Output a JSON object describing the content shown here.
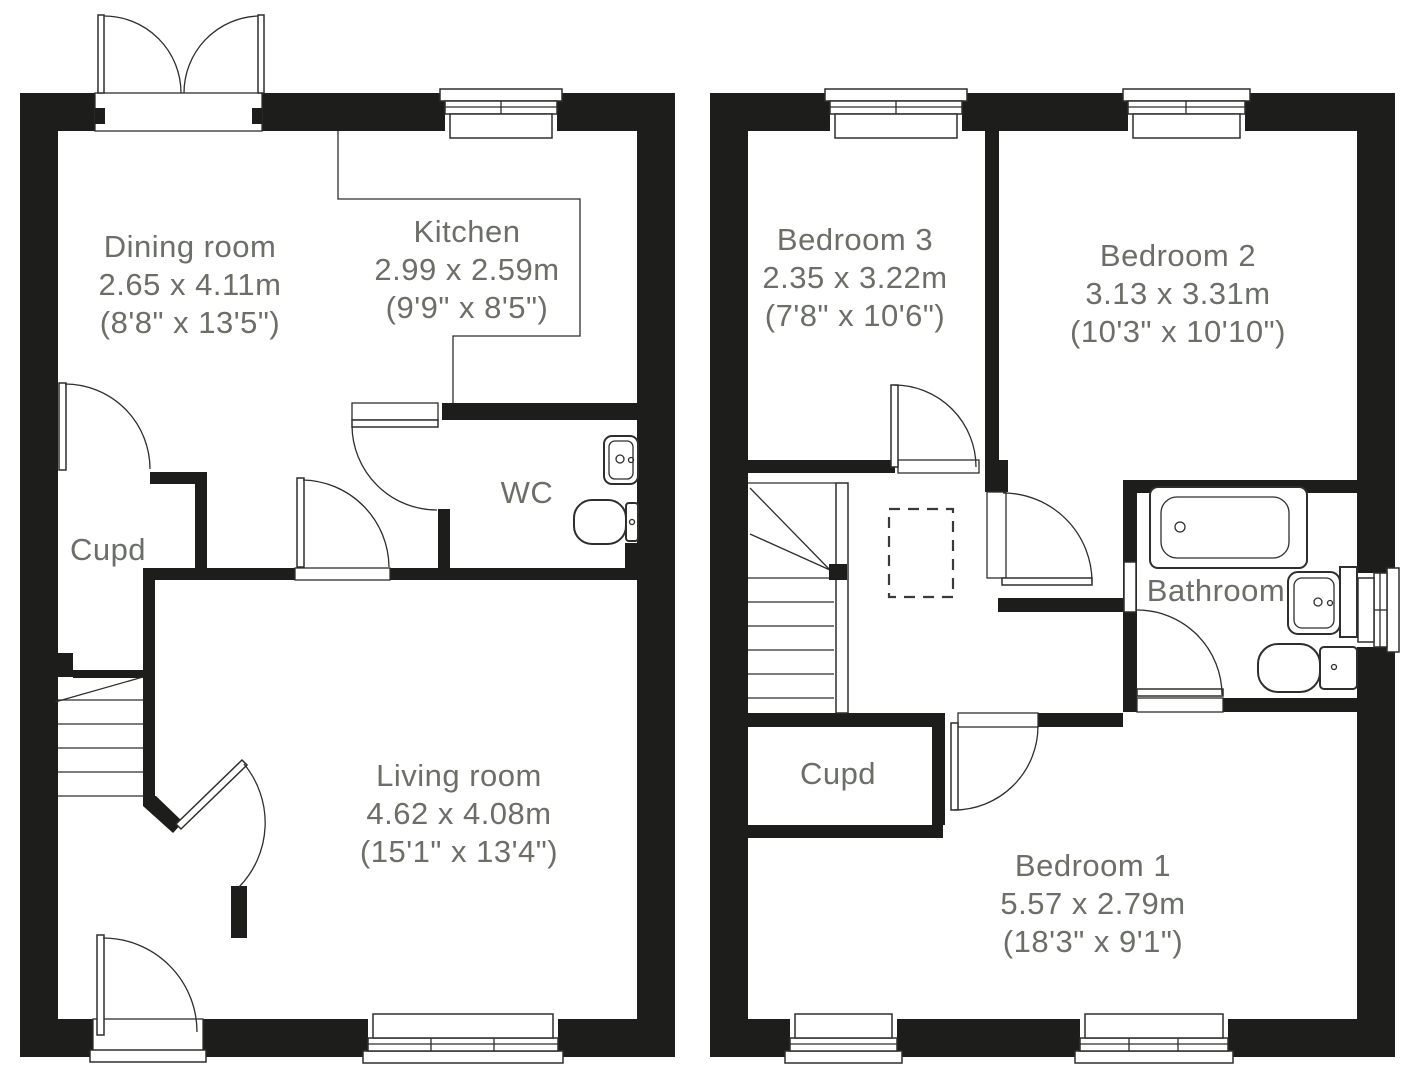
{
  "colors": {
    "wall": "#1d1d1b",
    "line": "#2e2e2c",
    "label_text": "#6c6f67",
    "background": "#ffffff"
  },
  "floors": {
    "ground": {
      "rooms": {
        "dining": {
          "name": "Dining room",
          "metric": "2.65 x 4.11m",
          "imperial": "(8'8\" x 13'5\")"
        },
        "kitchen": {
          "name": "Kitchen",
          "metric": "2.99 x 2.59m",
          "imperial": "(9'9\" x 8'5\")"
        },
        "wc": {
          "name": "WC"
        },
        "cupd": {
          "name": "Cupd"
        },
        "living": {
          "name": "Living room",
          "metric": "4.62 x 4.08m",
          "imperial": "(15'1\" x 13'4\")"
        }
      }
    },
    "first": {
      "rooms": {
        "bedroom3": {
          "name": "Bedroom 3",
          "metric": "2.35 x 3.22m",
          "imperial": "(7'8\" x 10'6\")"
        },
        "bedroom2": {
          "name": "Bedroom 2",
          "metric": "3.13 x 3.31m",
          "imperial": "(10'3\" x 10'10\")"
        },
        "bathroom": {
          "name": "Bathroom"
        },
        "cupd": {
          "name": "Cupd"
        },
        "bedroom1": {
          "name": "Bedroom 1",
          "metric": "5.57 x 2.79m",
          "imperial": "(18'3\" x 9'1\")"
        }
      }
    }
  }
}
